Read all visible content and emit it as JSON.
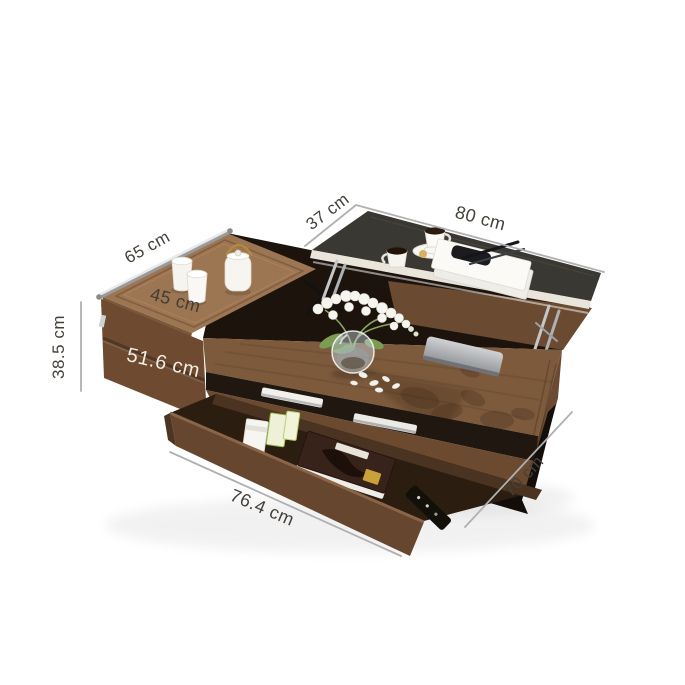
{
  "scene": {
    "background": "#ffffff",
    "subject": "lift-top coffee table with raised black top, sliding wood lid, open drawer and decor"
  },
  "labels": {
    "top_width": "37 cm",
    "top_length": "80 cm",
    "lid_length": "65 cm",
    "lid_width": "45 cm",
    "height": "38.5 cm",
    "left_depth": "51.6 cm",
    "drawer_length": "76.4 cm",
    "body_depth": "70 cm"
  },
  "colors": {
    "black_top": "#34312c",
    "lid_wood": "#9c7553",
    "surface_wood": "#7d5a3c",
    "front_wood": "#6b4a30",
    "drawer_wood": "#66462e",
    "drawer_interior": "#2c1d11",
    "base": "#130e09",
    "chrome": "#c9cbcd",
    "dimension_line": "#b0b0b0",
    "label_text": "#45403a",
    "label_text_light": "#f2ede3"
  }
}
